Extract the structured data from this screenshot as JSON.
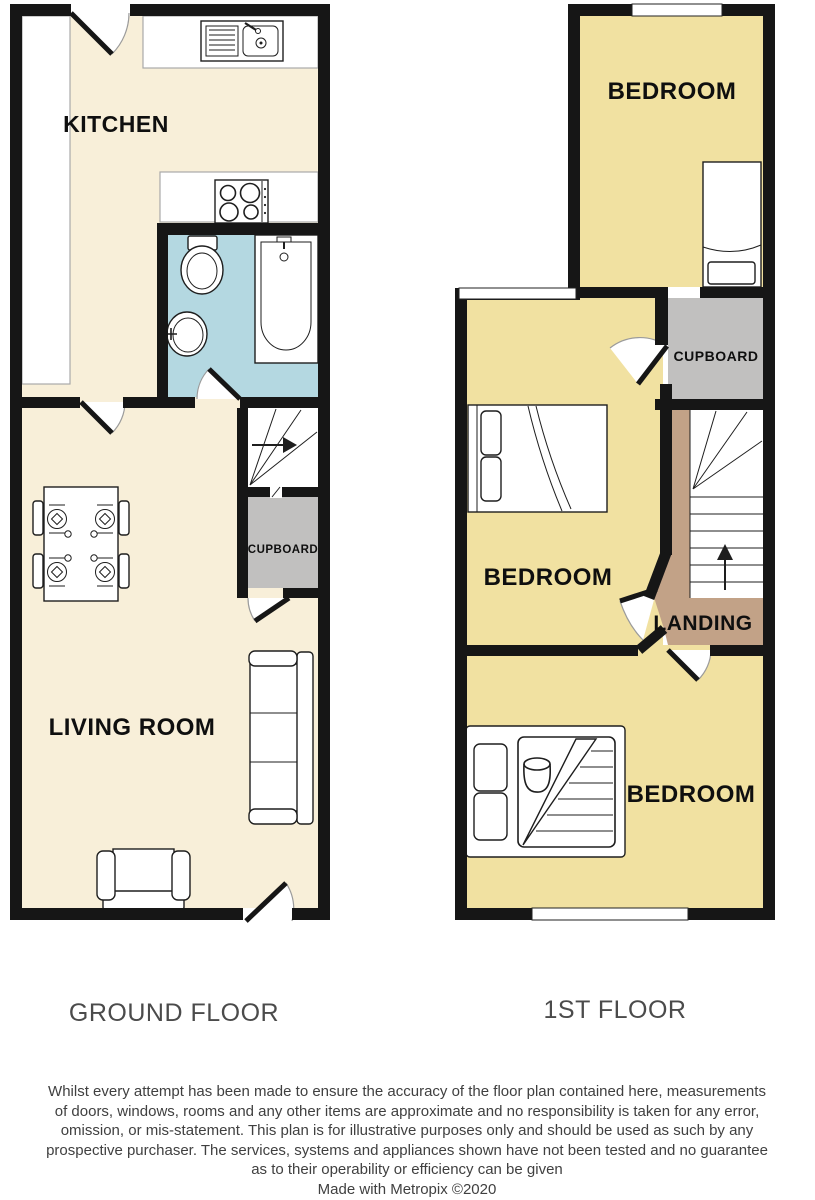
{
  "ground_floor": {
    "label": "GROUND FLOOR",
    "rooms": {
      "kitchen": "KITCHEN",
      "living_room": "LIVING ROOM",
      "cupboard": "CUPBOARD"
    }
  },
  "first_floor": {
    "label": "1ST FLOOR",
    "rooms": {
      "bedroom_top": "BEDROOM",
      "cupboard": "CUPBOARD",
      "bedroom_middle": "BEDROOM",
      "landing": "LANDING",
      "bedroom_bottom": "BEDROOM"
    }
  },
  "disclaimer": {
    "lines": [
      "Whilst every attempt has been made to ensure the accuracy of the floor plan contained here, measurements",
      "of doors, windows, rooms and any other items are approximate and no responsibility is taken for any error,",
      "omission, or mis-statement. This plan is for illustrative purposes only and should be used as such by any",
      "prospective purchaser. The services, systems and appliances shown have not been tested and no guarantee",
      "as to their operability or efficiency can be given"
    ],
    "credit": "Made with Metropix ©2020"
  },
  "colors": {
    "wall": "#161616",
    "cream": "#f8efd9",
    "bathroom_blue": "#b4d8e1",
    "bedroom_yellow": "#f1e1a1",
    "cupboard_gray": "#c1c0bf",
    "landing_tan": "#c2a287",
    "floor_label_gray": "#4b4b4b",
    "disclaimer_gray": "#404040"
  }
}
